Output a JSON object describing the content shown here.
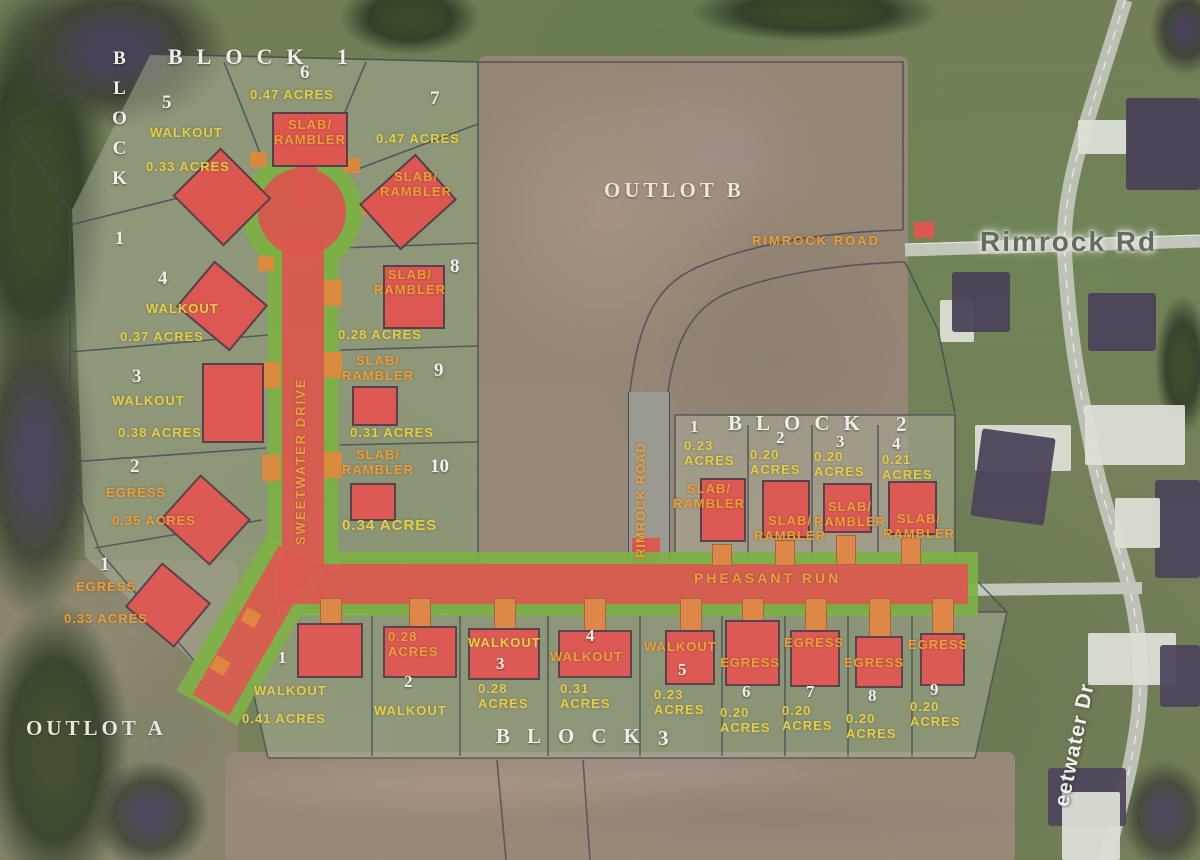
{
  "outlots": {
    "a": "OUTLOT A",
    "b": "OUTLOT B"
  },
  "roads": {
    "sweetwater_plat": "SWEETWATER DRIVE",
    "pheasant_run": "PHEASANT RUN",
    "rimrock_plat": "RIMROCK ROAD",
    "rimrock_future": "RIMROCK ROAD",
    "rimrock_existing": "Rimrock Rd",
    "sweetwater_existing": "eetwater Dr"
  },
  "block1": {
    "title": "BLOCK 1",
    "side_title": "BLOCK 1",
    "lots": [
      {
        "number": "1",
        "type": "EGRESS",
        "acres": "0.33 ACRES"
      },
      {
        "number": "2",
        "type": "EGRESS",
        "acres": "0.35 ACRES"
      },
      {
        "number": "3",
        "type": "WALKOUT",
        "acres": "0.38 ACRES"
      },
      {
        "number": "4",
        "type": "WALKOUT",
        "acres": "0.37 ACRES"
      },
      {
        "number": "5",
        "type": "WALKOUT",
        "acres": "0.33 ACRES"
      },
      {
        "number": "6",
        "type": "SLAB/\nRAMBLER",
        "acres": "0.47 ACRES"
      },
      {
        "number": "7",
        "type": "SLAB/\nRAMBLER",
        "acres": "0.47 ACRES"
      },
      {
        "number": "8",
        "type": "SLAB/\nRAMBLER",
        "acres": "0.28 ACRES"
      },
      {
        "number": "9",
        "type": "SLAB/\nRAMBLER",
        "acres": "0.31 ACRES"
      },
      {
        "number": "10",
        "type": "SLAB/\nRAMBLER",
        "acres": "0.34 ACRES"
      }
    ]
  },
  "block2": {
    "title": "BLOCK",
    "title_number": "2",
    "lots": [
      {
        "number": "1",
        "type": "SLAB/\nRAMBLER",
        "acres": "0.23\nACRES"
      },
      {
        "number": "2",
        "type": "SLAB/\nRAMBLER",
        "acres": "0.20\nACRES"
      },
      {
        "number": "3",
        "type": "SLAB/\nRAMBLER",
        "acres": "0.20\nACRES"
      },
      {
        "number": "4",
        "type": "SLAB/\nRAMBLER",
        "acres": "0.21\nACRES"
      }
    ]
  },
  "block3": {
    "title": "BLOCK",
    "title_number": "3",
    "lots": [
      {
        "number": "1",
        "type": "WALKOUT",
        "acres": "0.41 ACRES"
      },
      {
        "number": "2",
        "type": "WALKOUT",
        "acres": "0.28\nACRES"
      },
      {
        "number": "3",
        "type": "WALKOUT",
        "acres": "0.28\nACRES"
      },
      {
        "number": "4",
        "type": "WALKOUT",
        "acres": "0.31\nACRES"
      },
      {
        "number": "5",
        "type": "WALKOUT",
        "acres": "0.23\nACRES"
      },
      {
        "number": "6",
        "type": "EGRESS",
        "acres": "0.20\nACRES"
      },
      {
        "number": "7",
        "type": "EGRESS",
        "acres": "0.20\nACRES"
      },
      {
        "number": "8",
        "type": "EGRESS",
        "acres": "0.20\nACRES"
      },
      {
        "number": "9",
        "type": "EGRESS",
        "acres": "0.20\nACRES"
      }
    ]
  }
}
